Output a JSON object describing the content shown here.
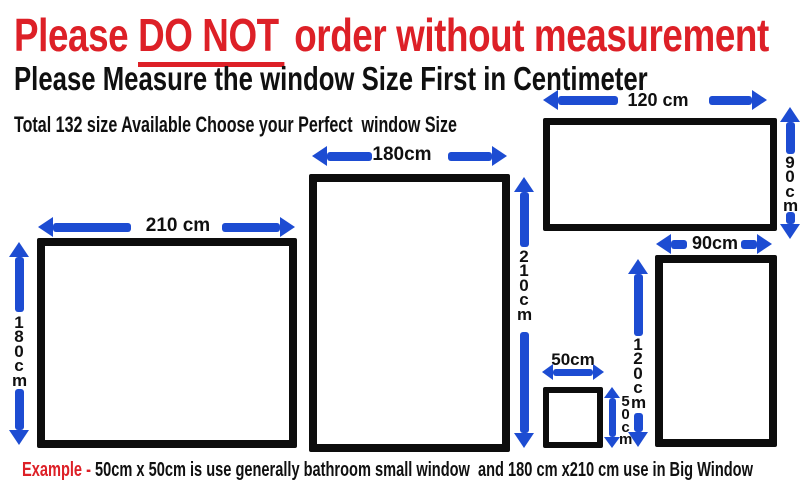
{
  "colors": {
    "red": "#dd2027",
    "blue": "#1d4cd2",
    "black": "#101010"
  },
  "header": {
    "title_prefix": "Please ",
    "title_emphasis": "DO NOT",
    "title_suffix": " order without measurement",
    "subtitle": "Please Measure the window Size First in Centimeter",
    "note": "Total 132 size Available Choose your Perfect  window Size"
  },
  "windows": [
    {
      "id": "window-210x180",
      "width_label": "210 cm",
      "height_label": "180cm"
    },
    {
      "id": "window-180x210",
      "width_label": "180cm",
      "height_label": "210cm"
    },
    {
      "id": "window-120x90",
      "width_label": "120 cm",
      "height_label": "90cm"
    },
    {
      "id": "window-90x120",
      "width_label": "90cm",
      "height_label": "120cm"
    },
    {
      "id": "window-50x50",
      "width_label": "50cm",
      "height_label": "50cm"
    }
  ],
  "footer": {
    "example_label": "Example - ",
    "example_text": "50cm x 50cm is use generally bathroom small window  and 180 cm x210 cm use in Big Window"
  }
}
